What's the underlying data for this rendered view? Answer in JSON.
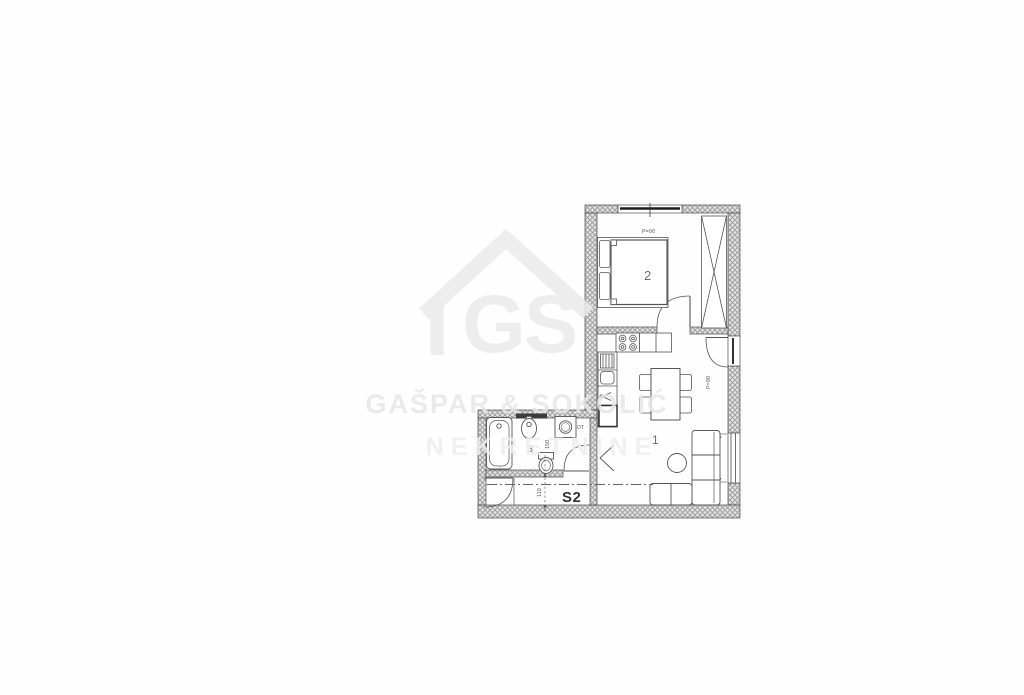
{
  "watermark": {
    "logo_text": "GS",
    "company_line1": "GAŠPAR & SOKOLIĆ",
    "company_line2": "NEKRETNINE"
  },
  "floorplan": {
    "unit_label": "S2",
    "rooms": [
      {
        "number": "1",
        "name": "living-dining-room"
      },
      {
        "number": "2",
        "name": "bedroom"
      },
      {
        "number": "3",
        "name": "bathroom"
      }
    ],
    "dims": {
      "top_window": "P=90",
      "balcony_window": "P=90",
      "right_window": "90",
      "bathroom": "150",
      "hallway": "110"
    },
    "labels": {
      "appliance": "OT"
    },
    "colors": {
      "background": "#ffffff",
      "line": "#4a4a4a",
      "wall_hatch": "#9b9b9b",
      "watermark": "#ebebeb"
    }
  }
}
